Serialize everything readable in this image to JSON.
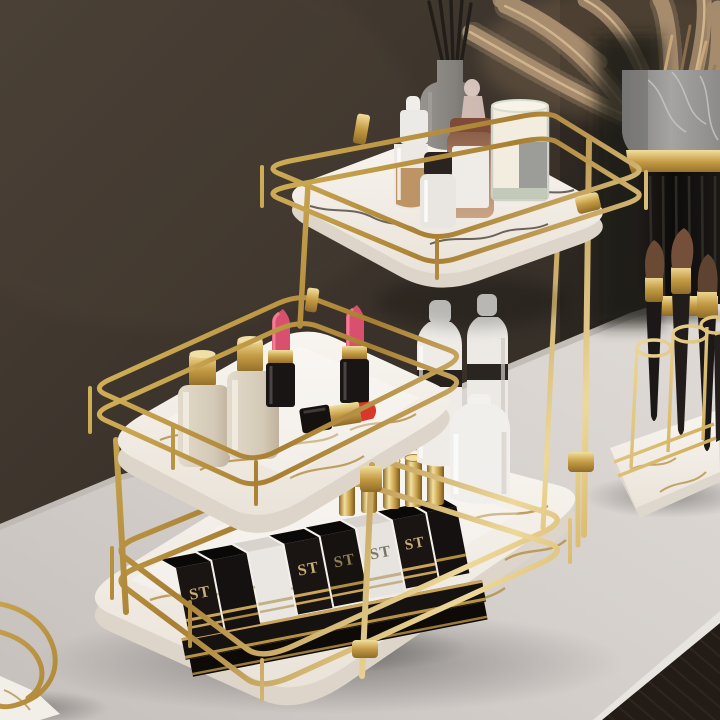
{
  "scene": {
    "type": "product-photograph",
    "subject": "Three-tier gold wire cosmetic organizer with white marble trays on a vanity table",
    "background": "dark brown wall",
    "surface": "light grey vanity tabletop"
  },
  "branding": {
    "st_box_label": "ST"
  },
  "inventory": {
    "top_tray": [
      "grey reed diffuser with black reeds",
      "white dropper serum bottle",
      "white bottle with black cap",
      "amber perfume bottle with glass stopper",
      "cream candle in glass with grey label"
    ],
    "middle_tray": [
      "two frosted bottles with gold caps",
      "two pink lipsticks open",
      "red lipstick lying open"
    ],
    "bottom_tray": [
      "row of black ST lipstick boxes with gold trim",
      "five gold lipstick tubes",
      "three white bottles with black bands"
    ],
    "right_side": [
      "pampas grass in marble and black fluted vase",
      "makeup brushes in gold wire holder on marble tray"
    ],
    "bottom_left": [
      "partial marble tray with gold rail"
    ]
  },
  "colors": {
    "wall": "#3b332b",
    "wall_dark": "#272220",
    "table": "#d7d2ce",
    "table_edge": "#e8e4e0",
    "floor": "#231c16",
    "gold_light": "#f4e6b0",
    "gold_mid": "#c9a84c",
    "gold_dark": "#8f6b28",
    "marble_white": "#f6f3ee",
    "marble_vein_gold": "#b5924a",
    "marble_vein_dark": "#49423a",
    "tray_side": "#e3dcd2",
    "lipstick_pink": "#d94f6e",
    "lipstick_red": "#d9372a",
    "amber_glass": "#b08262",
    "candle_wax": "#f2edde",
    "label_gray": "#9c9c99",
    "frosted_beige": "#d9d0c0",
    "box_black": "#17130f",
    "vase_marble": "#9b9a98",
    "vase_black": "#141110",
    "grass_tan": "#b2977a",
    "brush_bristle": "#6b4a33",
    "brush_handle": "#1c1817"
  }
}
